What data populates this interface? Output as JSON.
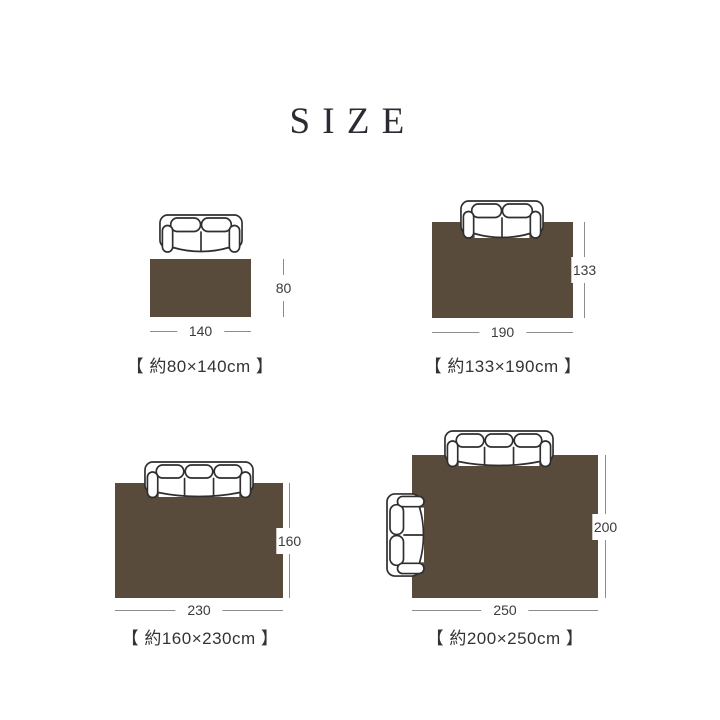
{
  "page": {
    "title": "SIZE"
  },
  "colors": {
    "background": "#ffffff",
    "rug": "#594b3b",
    "sofa_outline": "#2f2f2f",
    "dimension_line": "#8c8c8c",
    "dimension_text": "#3c3c3c",
    "caption_text": "#333333",
    "title_text": "#2b2b33"
  },
  "sizes": [
    {
      "name": "80x140",
      "caption": "【 約80×140cm 】",
      "depth_cm": 80,
      "width_cm": 140,
      "depth_label": "80",
      "width_label": "140",
      "furniture": [
        "two-seat-sofa"
      ]
    },
    {
      "name": "133x190",
      "caption": "【 約133×190cm 】",
      "depth_cm": 133,
      "width_cm": 190,
      "depth_label": "133",
      "width_label": "190",
      "furniture": [
        "two-seat-sofa"
      ]
    },
    {
      "name": "160x230",
      "caption": "【 約160×230cm 】",
      "depth_cm": 160,
      "width_cm": 230,
      "depth_label": "160",
      "width_label": "230",
      "furniture": [
        "three-seat-sofa"
      ]
    },
    {
      "name": "200x250",
      "caption": "【 約200×250cm 】",
      "depth_cm": 200,
      "width_cm": 250,
      "depth_label": "200",
      "width_label": "250",
      "furniture": [
        "three-seat-sofa",
        "two-seat-sofa-rotated"
      ]
    }
  ]
}
